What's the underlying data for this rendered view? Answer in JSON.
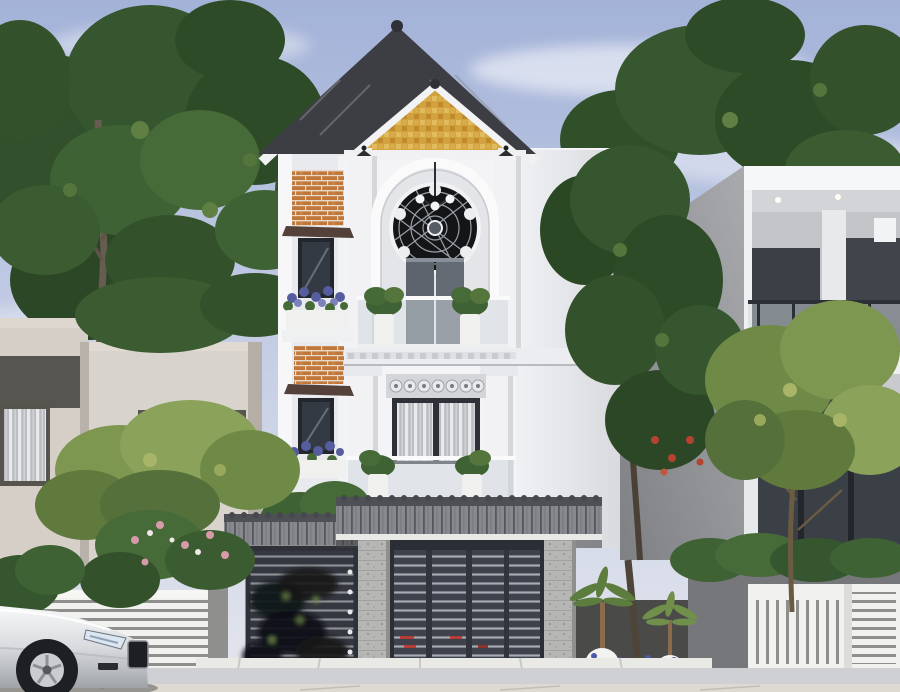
{
  "scene": {
    "type": "photorealistic architectural rendering (no UI, no legible text)",
    "description": "Three-storey white neoclassical townhouse with golden mosaic gable, arched niche with dark round ornamental window, plant-filled glass balconies and orange brick accents; street gate with grey tiled canopy, speckled stone pillars and dark slatted metal gates; modern beige neighbour house on the left, white modern house with balconies on the right; large green trees, white fences, garden pots with blue flowers, and a silver car in the lower-left foreground",
    "objects": [
      "sky",
      "clouds",
      "left trees",
      "right trees",
      "left neighbour house",
      "right neighbour house",
      "main townhouse",
      "gable roof",
      "golden gable panel",
      "wall lanterns",
      "round ornament window",
      "chandelier",
      "balcony railings",
      "planter pots",
      "brick accents",
      "window flower boxes",
      "gate canopy",
      "pedestrian gate canopy",
      "stone pillars",
      "slatted main gate",
      "pedestrian gate with blurred dark ornament",
      "white fences",
      "garden palms",
      "blue flower bed",
      "road",
      "curb",
      "silver car"
    ]
  },
  "palette": {
    "sky_top": "#a3b2d8",
    "sky_bottom": "#e4e6ed",
    "cloud": "#ffffff",
    "foliage_dark": "#2e4b28",
    "foliage_mid": "#3f6234",
    "foliage_light": "#6f8a47",
    "foliage_yellow": "#8aa259",
    "trunk_brown": "#5d5348",
    "house_white": "#f4f4f6",
    "house_shade": "#e4e5e9",
    "roof_gray": "#3c3e44",
    "fascia_white": "#f1f1f3",
    "gable_gold": "#d2a23e",
    "brick_orange": "#c1773a",
    "awning_brown": "#53413a",
    "window_glass": "#343a44",
    "window_frame": "#23262c",
    "glass_railing": "#cdd5db",
    "canopy_gray": "#87898e",
    "canopy_ridge": "#4e5055",
    "stone_gray": "#b6b7b5",
    "gate_metal": "#3f424c",
    "gate_frame": "#2c2e35",
    "ornament_black": "#141517",
    "left_building": "#d6cfc8",
    "left_recess": "#575550",
    "right_building": "#eef0f1",
    "right_side_wall": "#8f9195",
    "right_glass": "#3b4046",
    "fence_white": "#f1f1ef",
    "garden_soil": "#4a4b48",
    "flower_blue": "#4a5aa8",
    "flower_purple": "#565d9e",
    "flower_red": "#b4432f",
    "flower_pink": "#d79aa8",
    "pot_white": "#f2f2f0",
    "road_gray": "#cfd0d3",
    "curb_white": "#e9e9e5",
    "car_silver": "#d9dbde",
    "car_dark": "#1d1f22",
    "taillight_red": "#b93428"
  }
}
